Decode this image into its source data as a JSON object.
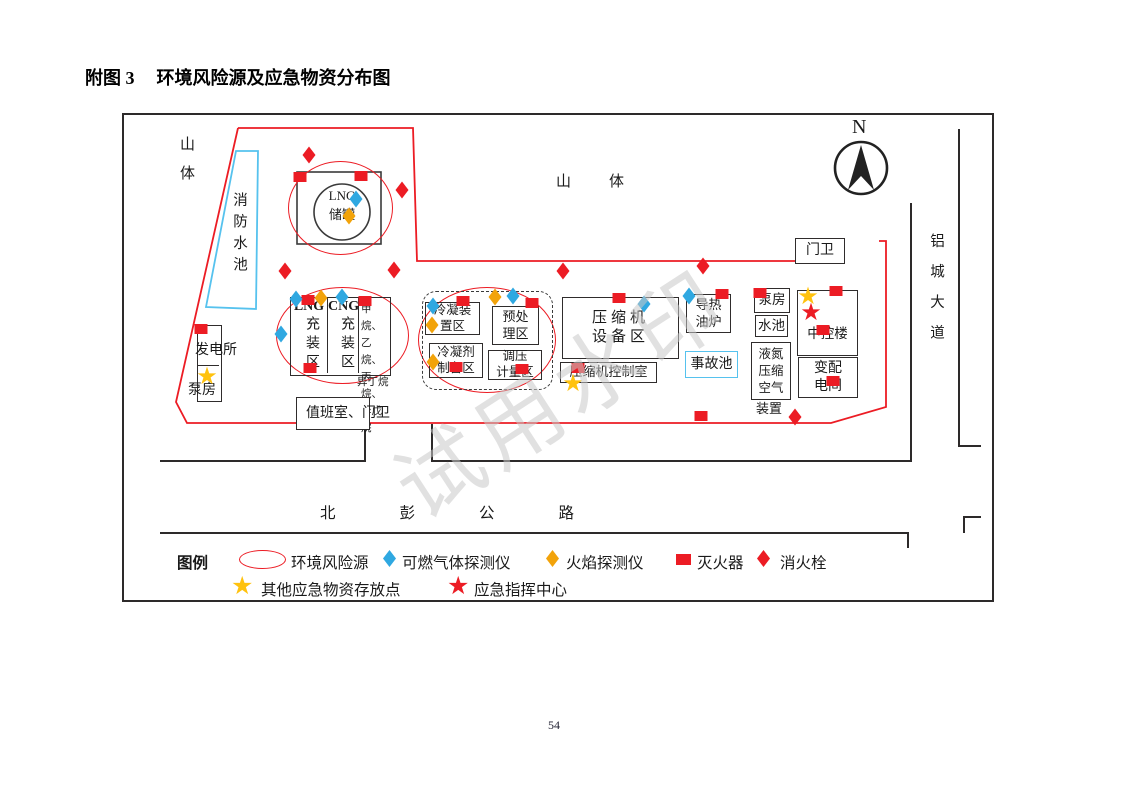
{
  "page": {
    "title_prefix": "附图 3",
    "title_text": "环境风险源及应急物资分布图",
    "page_number": "54",
    "watermark": "试用水印"
  },
  "colors": {
    "risk_red": "#EC1C24",
    "gas_blue": "#2FA8E1",
    "flame_yellow": "#F2A30A",
    "star_yellow": "#FFC20E",
    "pool_blue": "#56C2EE",
    "line_black": "#2d2a2a",
    "watermark_gray": "#C9C9C9"
  },
  "texts": {
    "mountain_left": "山体",
    "mountain_top": "山体",
    "road_south": "北彭公路",
    "road_east": "铝城大道",
    "north": "N"
  },
  "zones": {
    "fire_pool": "消防水池",
    "lng_tank": "LNG\n储罐",
    "lng_title": "LNG",
    "lng_body": "充装区",
    "cng_title": "CNG",
    "cng_body": "充装区",
    "alkanes": "甲烷、\n乙烷、\n丙烷、\n异戊烷",
    "isobutane": "异丁烷",
    "power_station": "发电所",
    "pump_left": "泵房",
    "duty_room": "值班室、门卫",
    "gate": "门卫",
    "cond_unit": "冷凝装\n置区",
    "pretreat": "预处\n理区",
    "cond_prep": "冷凝剂\n制备区",
    "pressure": "调压\n计量区",
    "compressor": "压缩机\n设备区",
    "comp_ctrl": "压缩机控制室",
    "oil_furnace": "导热\n油炉",
    "accident_pool": "事故池",
    "pump_right": "泵房",
    "water_pool": "水池",
    "ln_air": "液氮\n压缩\n空气",
    "ln_air_below": "装置",
    "control_bld": "中控楼",
    "substation": "变配\n电间"
  },
  "legend": {
    "title": "图例",
    "risk": "环境风险源",
    "gas": "可燃气体探测仪",
    "flame": "火焰探测仪",
    "ext": "灭火器",
    "hyd": "消火栓",
    "storage": "其他应急物资存放点",
    "command": "应急指挥中心"
  },
  "map": {
    "markers": [
      {
        "t": "hyd",
        "x": 309,
        "y": 155
      },
      {
        "t": "hyd",
        "x": 402,
        "y": 190
      },
      {
        "t": "hyd",
        "x": 285,
        "y": 271
      },
      {
        "t": "hyd",
        "x": 394,
        "y": 270
      },
      {
        "t": "hyd",
        "x": 563,
        "y": 271
      },
      {
        "t": "hyd",
        "x": 703,
        "y": 266
      },
      {
        "t": "hyd",
        "x": 795,
        "y": 417
      },
      {
        "t": "ext",
        "x": 300,
        "y": 177
      },
      {
        "t": "ext",
        "x": 361,
        "y": 176
      },
      {
        "t": "ext",
        "x": 308,
        "y": 300
      },
      {
        "t": "ext",
        "x": 365,
        "y": 301
      },
      {
        "t": "ext",
        "x": 310,
        "y": 368
      },
      {
        "t": "ext",
        "x": 201,
        "y": 329
      },
      {
        "t": "ext",
        "x": 463,
        "y": 301
      },
      {
        "t": "ext",
        "x": 532,
        "y": 303
      },
      {
        "t": "ext",
        "x": 456,
        "y": 367
      },
      {
        "t": "ext",
        "x": 522,
        "y": 369
      },
      {
        "t": "ext",
        "x": 619,
        "y": 298
      },
      {
        "t": "ext",
        "x": 578,
        "y": 368
      },
      {
        "t": "ext",
        "x": 722,
        "y": 294
      },
      {
        "t": "ext",
        "x": 760,
        "y": 293
      },
      {
        "t": "ext",
        "x": 836,
        "y": 291
      },
      {
        "t": "ext",
        "x": 823,
        "y": 330
      },
      {
        "t": "ext",
        "x": 833,
        "y": 381
      },
      {
        "t": "ext",
        "x": 701,
        "y": 416
      },
      {
        "t": "gas",
        "x": 356,
        "y": 199
      },
      {
        "t": "gas",
        "x": 296,
        "y": 299
      },
      {
        "t": "gas",
        "x": 342,
        "y": 297
      },
      {
        "t": "gas",
        "x": 281,
        "y": 334
      },
      {
        "t": "gas",
        "x": 433,
        "y": 306
      },
      {
        "t": "gas",
        "x": 513,
        "y": 296
      },
      {
        "t": "gas",
        "x": 644,
        "y": 304
      },
      {
        "t": "gas",
        "x": 689,
        "y": 296
      },
      {
        "t": "flame",
        "x": 349,
        "y": 216
      },
      {
        "t": "flame",
        "x": 321,
        "y": 298
      },
      {
        "t": "flame",
        "x": 432,
        "y": 325
      },
      {
        "t": "flame",
        "x": 495,
        "y": 297
      },
      {
        "t": "flame",
        "x": 433,
        "y": 362
      },
      {
        "t": "sy",
        "x": 207,
        "y": 376
      },
      {
        "t": "sy",
        "x": 573,
        "y": 383
      },
      {
        "t": "sy",
        "x": 808,
        "y": 296
      },
      {
        "t": "sr",
        "x": 811,
        "y": 312
      }
    ]
  }
}
